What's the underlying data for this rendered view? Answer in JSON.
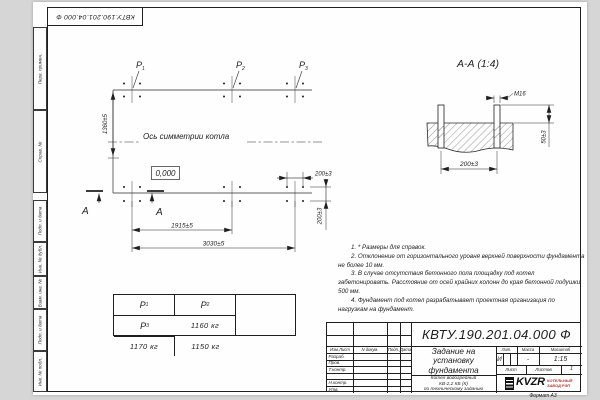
{
  "frame": {
    "doc_number_top": "КВТУ.190.201.04.000 Ф",
    "format_note": "Формат А3",
    "margin_labels": [
      "Перв. примен.",
      "Справ. №",
      "Подп. и дата",
      "Инв. № дубл.",
      "Взам. инв. №",
      "Подп. и дата",
      "Инв. № подл."
    ]
  },
  "plan": {
    "axis_label": "Ось симметрии котла",
    "elevation_label": "0,000",
    "section_letter_left": "А",
    "section_letter_right": "А",
    "load_points": [
      {
        "name": "P",
        "sub": "1"
      },
      {
        "name": "P",
        "sub": "2"
      },
      {
        "name": "P",
        "sub": "3"
      }
    ],
    "dim_height": "1360±5",
    "dim_mid": "1915±5",
    "dim_total": "3030±5",
    "dim_bolt_h": "200±3",
    "dim_bolt_v": "200±3"
  },
  "section": {
    "title": "А-А (1:4)",
    "thread_label": "М16",
    "dim_spacing": "200±3",
    "dim_height": "50±3"
  },
  "notes": [
    "1. * Размеры для справок.",
    "2. Отклонение от горизонтального уровня верхней поверхности фундамента не более 10 мм.",
    "3. В случае отсутствия бетонного пола площадку под котел забетонировать. Расстояние от осей крайних колонн до края бетонной подушки 500 мм.",
    "4. Фундамент под котел разрабатывает проектная организация по нагрузкам на фундамент."
  ],
  "load_table": {
    "headers": [
      {
        "name": "P",
        "sub": "1"
      },
      {
        "name": "P",
        "sub": "2"
      },
      {
        "name": "P",
        "sub": "3"
      }
    ],
    "values": [
      "1160 кг",
      "1170 кг",
      "1150 кг"
    ]
  },
  "title_block": {
    "doc_number": "КВТУ.190.201.04.000 Ф",
    "title_lines": [
      "Задание на",
      "установку",
      "фундамента"
    ],
    "product_lines": [
      "Котел водогрейный",
      "КВ-2,2 КБ (К)",
      "по техническому заданию"
    ],
    "header_cols": [
      "Изм.Лист",
      "N докум.",
      "Подп.",
      "Дата"
    ],
    "row_labels": [
      "Разраб.",
      "Пров.",
      "Т.контр.",
      "",
      "Н.контр.",
      "Утв."
    ],
    "lit_label": "Лит.",
    "lit_value": "И",
    "mass_label": "Масса",
    "mass_value": "-",
    "scale_label": "Масштаб",
    "scale_value": "1:15",
    "sheet_label": "Лист",
    "sheets_label": "Листов",
    "sheets_value": "1",
    "logo_text": "KVZR",
    "logo_caption_lines": [
      "КОТЕЛЬНЫЙ",
      "ЗАВОД РЭП"
    ]
  },
  "colors": {
    "line": "#1f1f1f",
    "logo_red": "#b03a2e",
    "paper": "#fefefe",
    "background": "#d6d6d6"
  }
}
